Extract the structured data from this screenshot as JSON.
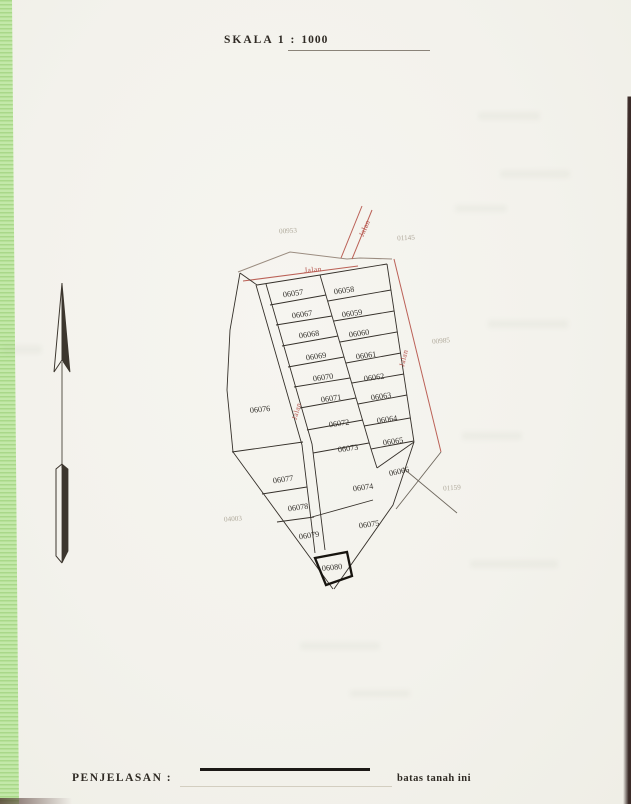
{
  "document": {
    "scale_label": "SKALA 1 :",
    "scale_value": "1000"
  },
  "legend": {
    "label": "PENJELASAN :",
    "symbol_description": "batas tanah ini"
  },
  "map": {
    "road_label": "Jalan",
    "parcel_numbers": [
      "06057",
      "06058",
      "06067",
      "06059",
      "06068",
      "06060",
      "06069",
      "06061",
      "06070",
      "06062",
      "06071",
      "06063",
      "06072",
      "06064",
      "06073",
      "06065",
      "06074",
      "06066",
      "06075",
      "06076",
      "06077",
      "06078",
      "06079",
      "06080"
    ],
    "adjacent_parcel_numbers": [
      "00953",
      "01145",
      "00985",
      "01159",
      "04003"
    ],
    "colors": {
      "road_line": "#bb6157",
      "road_text": "#b5524a",
      "parcel_boundary": "#35302a",
      "highlighted_parcel_border": "#17140f"
    }
  }
}
